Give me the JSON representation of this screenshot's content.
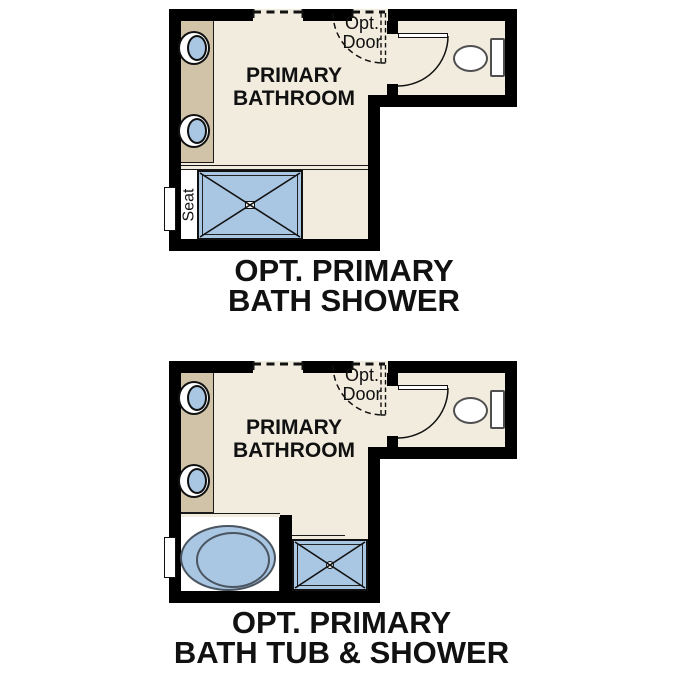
{
  "colors": {
    "floor": "#f2ecdf",
    "vanity": "#d1c3a8",
    "fixture": "#a9c6e3",
    "wall": "#000000",
    "line": "#1a1a1a",
    "text": "#111111"
  },
  "plans": [
    {
      "room_label": [
        "PRIMARY",
        "BATHROOM"
      ],
      "opt_door_label": [
        "Opt.",
        "Door"
      ],
      "seat_label": "Seat",
      "caption": [
        "OPT. PRIMARY",
        "BATH SHOWER"
      ]
    },
    {
      "room_label": [
        "PRIMARY",
        "BATHROOM"
      ],
      "opt_door_label": [
        "Opt.",
        "Door"
      ],
      "caption": [
        "OPT. PRIMARY",
        "BATH TUB & SHOWER"
      ]
    }
  ]
}
